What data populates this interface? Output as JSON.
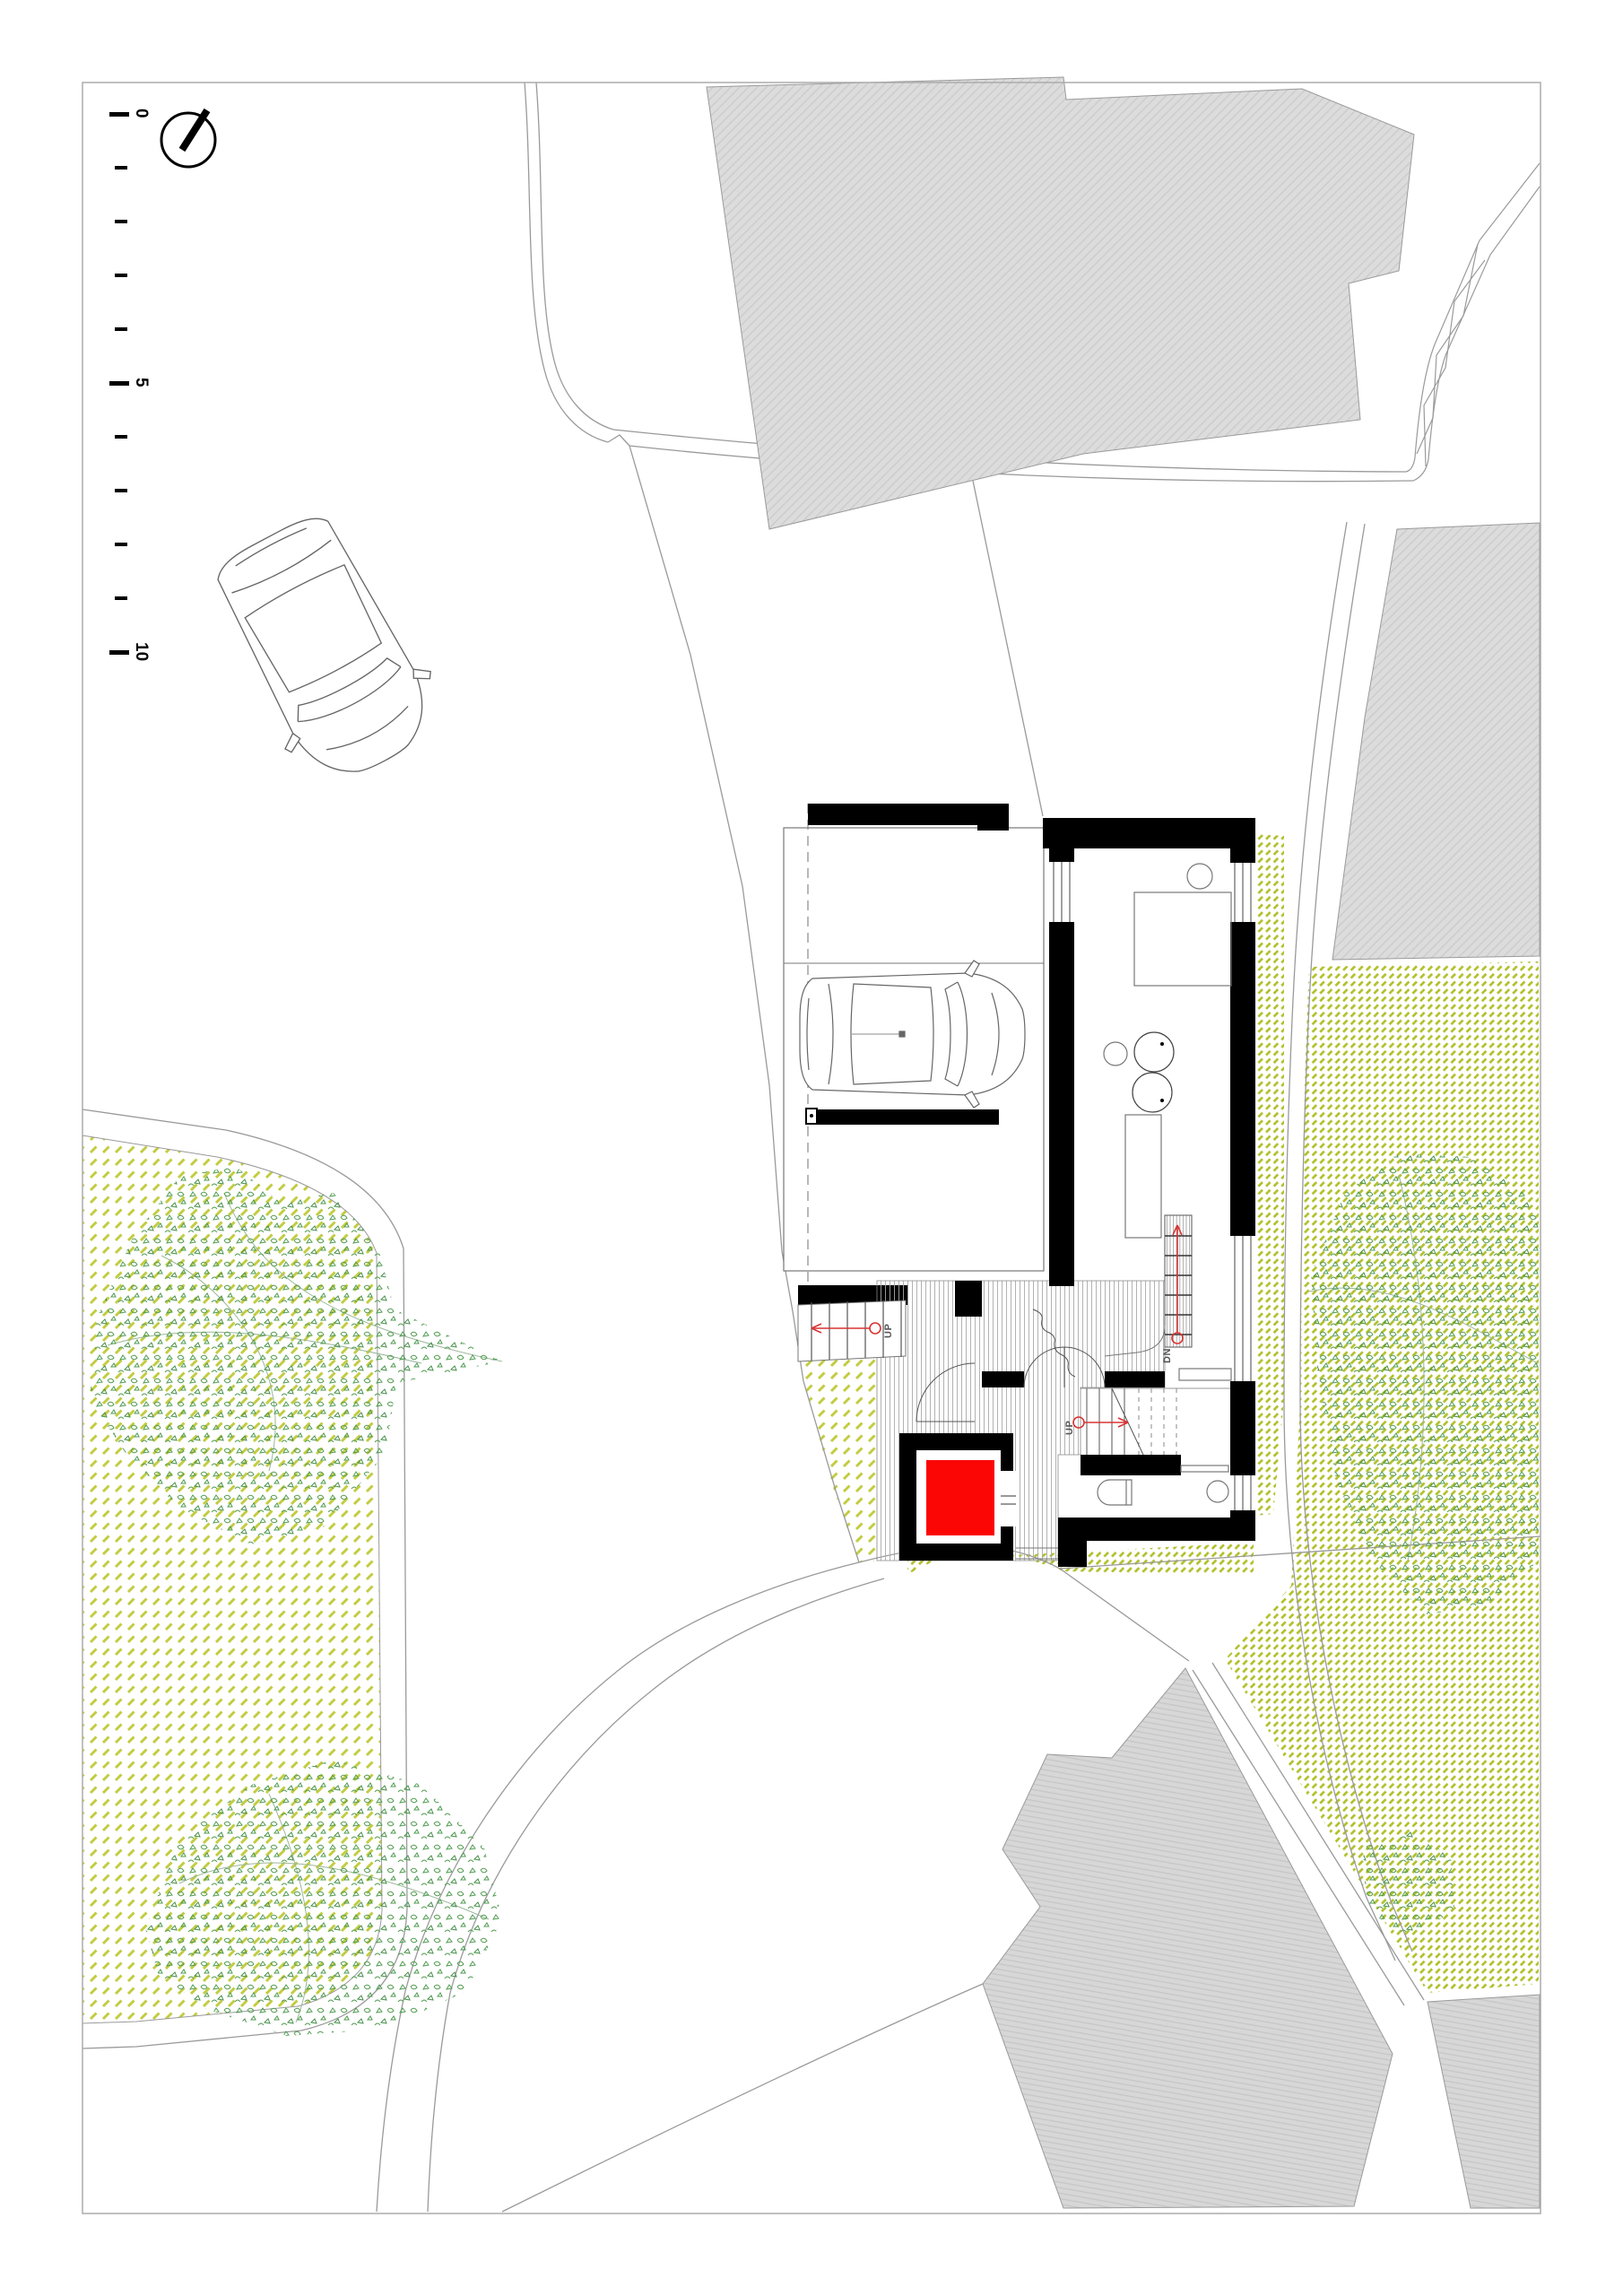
{
  "page": {
    "background": "#ffffff",
    "frame_color": "#ababab"
  },
  "scale_bar": {
    "orientation": "vertical",
    "labels": [
      "0",
      "5",
      "10"
    ]
  },
  "compass": {
    "icon": "north-arrow"
  },
  "annotations": {
    "up_exterior": "UP",
    "up_interior": "UP",
    "down": "DN"
  },
  "palette": {
    "wall_black": "#000000",
    "elevator_red": "#fb0505",
    "arrow_red": "#d93434",
    "building_gray": "#dcdcdc",
    "grass_dash_green": "#b9c632",
    "leaf_green": "#4e9b50",
    "site_line_gray": "#9a9a9a"
  }
}
